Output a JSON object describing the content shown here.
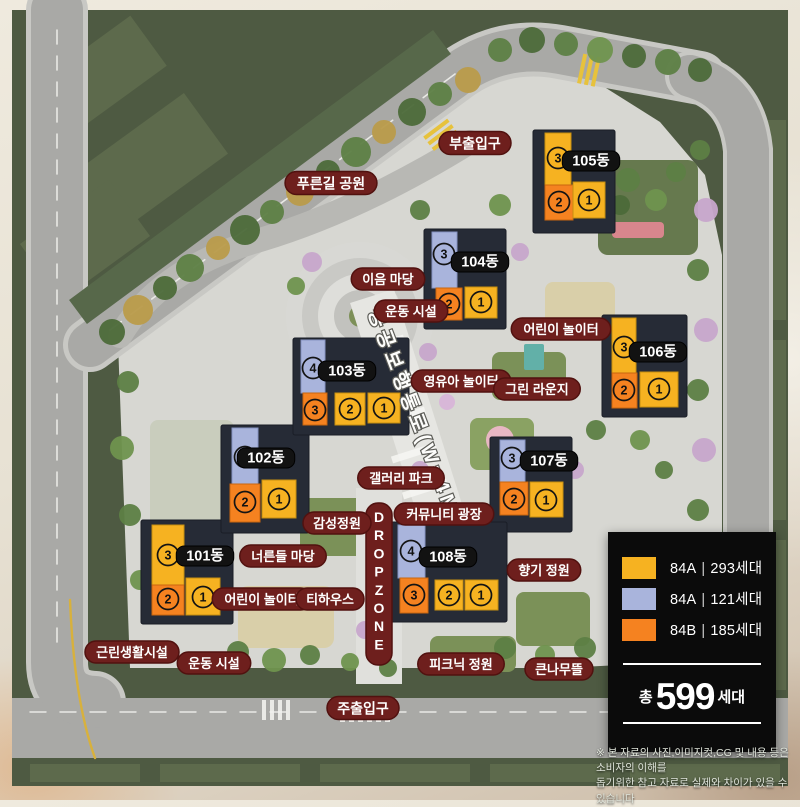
{
  "colors": {
    "roof_yellow": "#F6B221",
    "roof_blue": "#A9B4DC",
    "roof_orange": "#F58220",
    "building_dark": "#262b36",
    "label_pill": "#6E1F1D",
    "label_pill_border": "#51110F",
    "dong_pill": "#121212",
    "dropzone_pill": "#6E1F1D"
  },
  "map": {
    "corridor_label": "공공보행통로(W=4M)",
    "dropzone_label": "DROPZONE",
    "park_label": {
      "label": "푸른길 공원",
      "x": 331,
      "y": 183
    },
    "entrances": [
      {
        "label": "부출입구",
        "x": 475,
        "y": 143
      },
      {
        "label": "주출입구",
        "x": 363,
        "y": 708
      }
    ],
    "facilities": [
      {
        "label": "이음 마당",
        "x": 388,
        "y": 279
      },
      {
        "label": "운동 시설",
        "x": 411,
        "y": 311
      },
      {
        "label": "어린이 놀이터",
        "x": 561,
        "y": 329
      },
      {
        "label": "영유아 놀이터",
        "x": 461,
        "y": 381
      },
      {
        "label": "그린 라운지",
        "x": 537,
        "y": 389
      },
      {
        "label": "갤러리 파크",
        "x": 401,
        "y": 478
      },
      {
        "label": "커뮤니티 광장",
        "x": 444,
        "y": 514
      },
      {
        "label": "감성정원",
        "x": 337,
        "y": 523
      },
      {
        "label": "너른들 마당",
        "x": 283,
        "y": 556
      },
      {
        "label": "향기 정원",
        "x": 544,
        "y": 570
      },
      {
        "label": "어린이 놀이터",
        "x": 262,
        "y": 599
      },
      {
        "label": "티하우스",
        "x": 330,
        "y": 599
      },
      {
        "label": "근린생활시설",
        "x": 132,
        "y": 652
      },
      {
        "label": "운동 시설",
        "x": 214,
        "y": 663
      },
      {
        "label": "피크닉 정원",
        "x": 461,
        "y": 664
      },
      {
        "label": "큰나무뜰",
        "x": 559,
        "y": 669
      }
    ],
    "buildings": [
      {
        "name": "101동",
        "label_x": 205,
        "label_y": 556,
        "base": [
          141,
          520,
          92,
          104
        ],
        "roofs": [
          {
            "x": 152,
            "y": 525,
            "w": 32,
            "h": 60,
            "c": "yellow"
          },
          {
            "x": 152,
            "y": 585,
            "w": 32,
            "h": 30,
            "c": "orange"
          },
          {
            "x": 186,
            "y": 578,
            "w": 34,
            "h": 37,
            "c": "yellow"
          }
        ],
        "units": [
          {
            "n": "3",
            "x": 168,
            "y": 555
          },
          {
            "n": "2",
            "x": 168,
            "y": 599
          },
          {
            "n": "1",
            "x": 203,
            "y": 597
          }
        ]
      },
      {
        "name": "102동",
        "label_x": 266,
        "label_y": 458,
        "base": [
          221,
          425,
          88,
          108
        ],
        "roofs": [
          {
            "x": 232,
            "y": 428,
            "w": 26,
            "h": 56,
            "c": "blue"
          },
          {
            "x": 230,
            "y": 484,
            "w": 30,
            "h": 38,
            "c": "orange"
          },
          {
            "x": 262,
            "y": 480,
            "w": 34,
            "h": 38,
            "c": "yellow"
          }
        ],
        "units": [
          {
            "n": "3",
            "x": 245,
            "y": 457
          },
          {
            "n": "2",
            "x": 245,
            "y": 502
          },
          {
            "n": "1",
            "x": 279,
            "y": 499
          }
        ]
      },
      {
        "name": "103동",
        "label_x": 347,
        "label_y": 371,
        "base": [
          293,
          338,
          116,
          97
        ],
        "roofs": [
          {
            "x": 301,
            "y": 340,
            "w": 24,
            "h": 53,
            "c": "blue"
          },
          {
            "x": 303,
            "y": 393,
            "w": 24,
            "h": 32,
            "c": "orange"
          },
          {
            "x": 335,
            "y": 393,
            "w": 30,
            "h": 32,
            "c": "yellow"
          },
          {
            "x": 368,
            "y": 393,
            "w": 32,
            "h": 30,
            "c": "yellow"
          }
        ],
        "units": [
          {
            "n": "4",
            "x": 313,
            "y": 368
          },
          {
            "n": "3",
            "x": 315,
            "y": 410
          },
          {
            "n": "2",
            "x": 350,
            "y": 409
          },
          {
            "n": "1",
            "x": 384,
            "y": 408
          }
        ]
      },
      {
        "name": "104동",
        "label_x": 480,
        "label_y": 262,
        "base": [
          424,
          229,
          82,
          100
        ],
        "roofs": [
          {
            "x": 432,
            "y": 232,
            "w": 25,
            "h": 56,
            "c": "blue"
          },
          {
            "x": 436,
            "y": 288,
            "w": 26,
            "h": 32,
            "c": "orange"
          },
          {
            "x": 465,
            "y": 287,
            "w": 32,
            "h": 31,
            "c": "yellow"
          }
        ],
        "units": [
          {
            "n": "3",
            "x": 444,
            "y": 254
          },
          {
            "n": "2",
            "x": 449,
            "y": 304
          },
          {
            "n": "1",
            "x": 481,
            "y": 302
          }
        ]
      },
      {
        "name": "105동",
        "label_x": 591,
        "label_y": 161,
        "base": [
          533,
          130,
          82,
          103
        ],
        "roofs": [
          {
            "x": 545,
            "y": 133,
            "w": 26,
            "h": 52,
            "c": "yellow"
          },
          {
            "x": 545,
            "y": 185,
            "w": 28,
            "h": 35,
            "c": "orange"
          },
          {
            "x": 573,
            "y": 182,
            "w": 32,
            "h": 36,
            "c": "yellow"
          }
        ],
        "units": [
          {
            "n": "3",
            "x": 558,
            "y": 158
          },
          {
            "n": "2",
            "x": 559,
            "y": 202
          },
          {
            "n": "1",
            "x": 589,
            "y": 200
          }
        ]
      },
      {
        "name": "106동",
        "label_x": 658,
        "label_y": 352,
        "base": [
          602,
          315,
          85,
          102
        ],
        "roofs": [
          {
            "x": 612,
            "y": 318,
            "w": 24,
            "h": 55,
            "c": "yellow"
          },
          {
            "x": 612,
            "y": 373,
            "w": 25,
            "h": 35,
            "c": "orange"
          },
          {
            "x": 640,
            "y": 372,
            "w": 38,
            "h": 35,
            "c": "yellow"
          }
        ],
        "units": [
          {
            "n": "3",
            "x": 624,
            "y": 347
          },
          {
            "n": "2",
            "x": 624,
            "y": 390
          },
          {
            "n": "1",
            "x": 659,
            "y": 389
          }
        ]
      },
      {
        "name": "107동",
        "label_x": 549,
        "label_y": 461,
        "base": [
          490,
          437,
          82,
          95
        ],
        "roofs": [
          {
            "x": 500,
            "y": 440,
            "w": 25,
            "h": 42,
            "c": "blue"
          },
          {
            "x": 500,
            "y": 482,
            "w": 28,
            "h": 33,
            "c": "orange"
          },
          {
            "x": 530,
            "y": 482,
            "w": 33,
            "h": 35,
            "c": "yellow"
          }
        ],
        "units": [
          {
            "n": "3",
            "x": 512,
            "y": 458
          },
          {
            "n": "2",
            "x": 514,
            "y": 499
          },
          {
            "n": "1",
            "x": 546,
            "y": 500
          }
        ]
      },
      {
        "name": "108동",
        "label_x": 448,
        "label_y": 557,
        "base": [
          389,
          522,
          118,
          100
        ],
        "roofs": [
          {
            "x": 398,
            "y": 525,
            "w": 27,
            "h": 53,
            "c": "blue"
          },
          {
            "x": 400,
            "y": 578,
            "w": 28,
            "h": 35,
            "c": "orange"
          },
          {
            "x": 435,
            "y": 580,
            "w": 28,
            "h": 30,
            "c": "yellow"
          },
          {
            "x": 465,
            "y": 580,
            "w": 33,
            "h": 30,
            "c": "yellow"
          }
        ],
        "units": [
          {
            "n": "4",
            "x": 411,
            "y": 551
          },
          {
            "n": "3",
            "x": 414,
            "y": 595
          },
          {
            "n": "2",
            "x": 449,
            "y": 595
          },
          {
            "n": "1",
            "x": 481,
            "y": 595
          }
        ]
      }
    ]
  },
  "legend": {
    "sep": "|",
    "items": [
      {
        "code": "84A",
        "units": "293세대",
        "color": "#F6B221"
      },
      {
        "code": "84A",
        "units": "121세대",
        "color": "#A9B4DC"
      },
      {
        "code": "84B",
        "units": "185세대",
        "color": "#F58220"
      }
    ],
    "total_prefix": "총",
    "total_value": "599",
    "total_suffix": "세대"
  },
  "disclaimer": {
    "line1": "※ 본 자료의 사진,이미지컷,CG 및 내용 등은 소비자의 이해를",
    "line2": "돕기위한 참고 자료로 실제와 차이가 있을 수 있습니다"
  }
}
